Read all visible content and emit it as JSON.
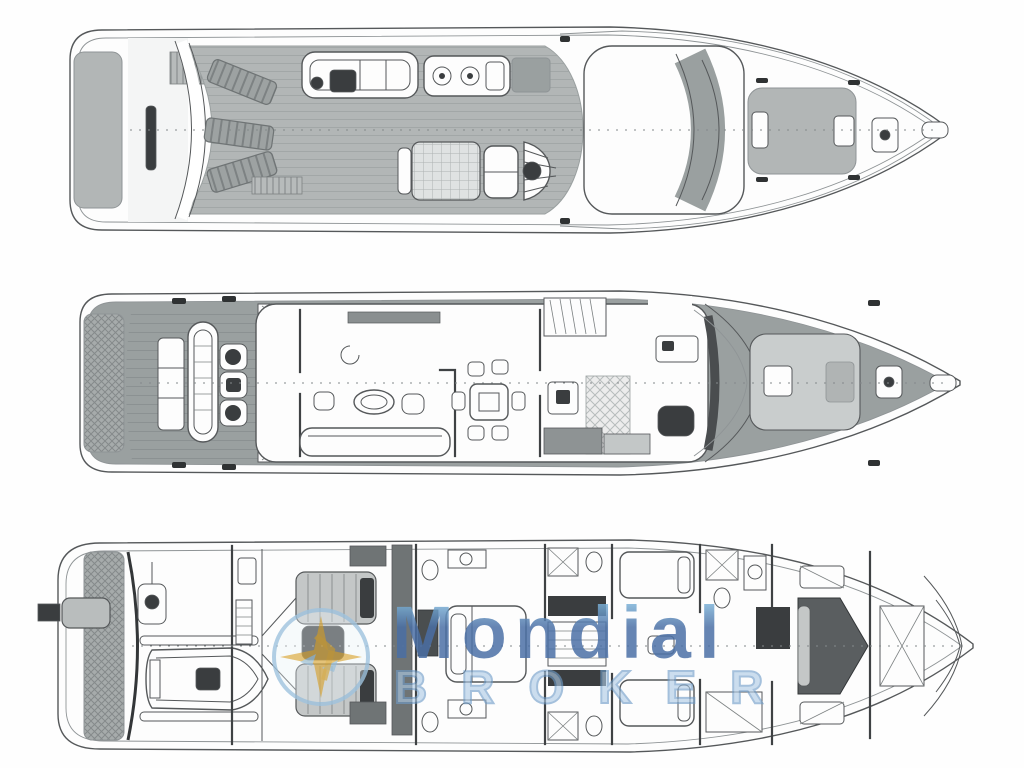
{
  "watermark": {
    "brand": "Mondial",
    "sub": "BROKER"
  },
  "colors": {
    "line": "#55585a",
    "line_light": "#8f9496",
    "deck_gray": "#b2b6b6",
    "deck_gray_dark": "#9aa0a0",
    "pad_light": "#c9cdcd",
    "furniture_dark": "#3a3d3f",
    "tank_gray": "#6f7475",
    "white": "#fdfdfd",
    "brand_blue": "#4a6fa5",
    "brand_highlight": "#8cc8e8",
    "broker_fill": "#aecbe6",
    "broker_stroke": "#6f9cc8",
    "logo_gold": "#d9a93c",
    "logo_blue": "#9fc3de"
  }
}
